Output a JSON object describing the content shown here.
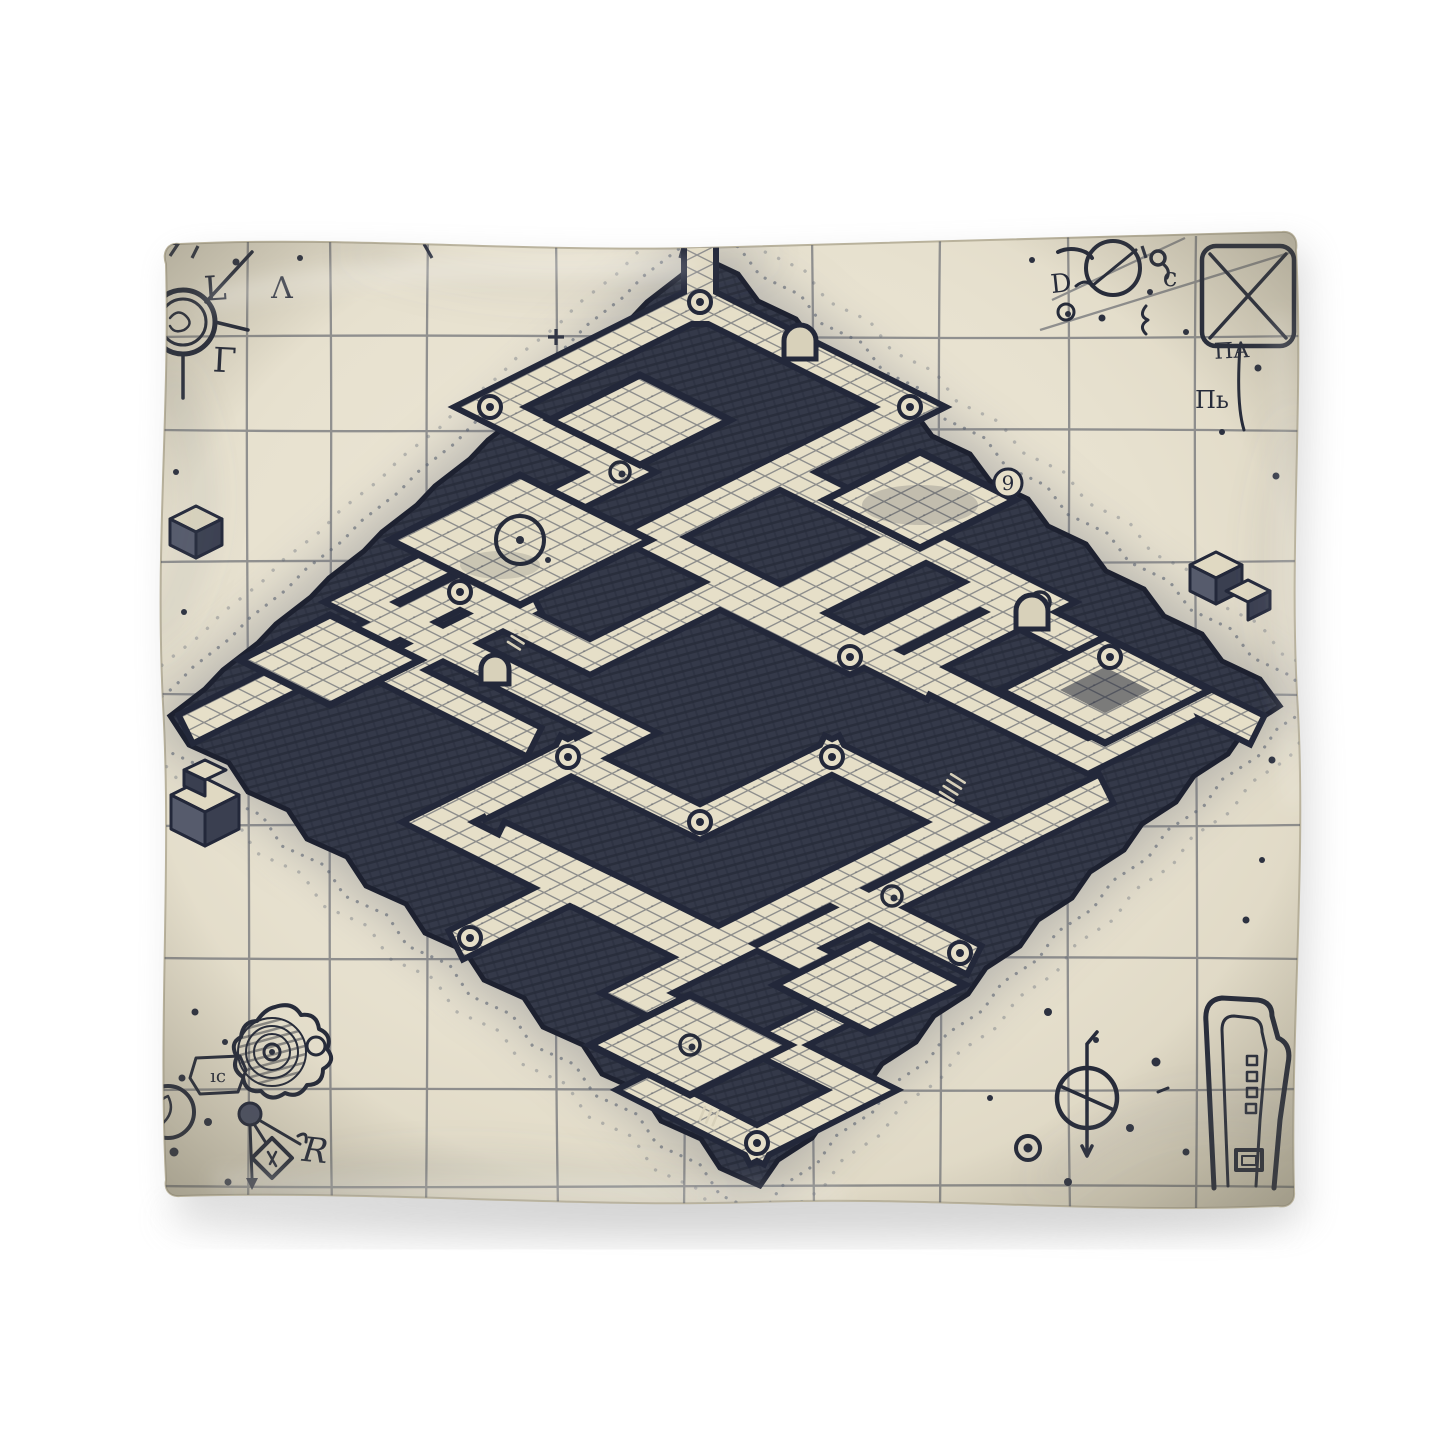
{
  "colors": {
    "page_background": "#ffffff",
    "parchment": "#e8e2d0",
    "parchment_shadow": "#d3ccb6",
    "ink_dark": "#23283a",
    "ink": "#343949",
    "ink_mid": "#565b6c",
    "tile_cream": "#e6dfc8",
    "grid_line": "#3a4050",
    "drop_shadow": "#9a9a9a"
  },
  "glyphs": [
    {
      "name": "letter-l",
      "char": "L"
    },
    {
      "name": "letter-lambda",
      "char": "Λ"
    },
    {
      "name": "letter-gamma",
      "char": "Γ"
    },
    {
      "name": "letter-d",
      "char": "D"
    },
    {
      "name": "letter-c",
      "char": "c"
    },
    {
      "name": "rune-pi-a",
      "char": "ΠA"
    },
    {
      "name": "rune-p-soft",
      "char": "Пь"
    },
    {
      "name": "numeral-nine",
      "char": "9"
    },
    {
      "name": "shield-mark",
      "char": "ıc"
    },
    {
      "name": "letter-r",
      "char": "R"
    }
  ],
  "ornaments": [
    "ring-medallion",
    "compass-circle",
    "crossed-panel",
    "teardrop-loop",
    "spiral-knot",
    "rosette-medallion",
    "leaf-circle",
    "rune-diamond",
    "pointer-arrow",
    "keyhole-bracket",
    "phi-compass",
    "dot-cluster",
    "iso-cube",
    "stone-arch",
    "corridor-rivet"
  ]
}
